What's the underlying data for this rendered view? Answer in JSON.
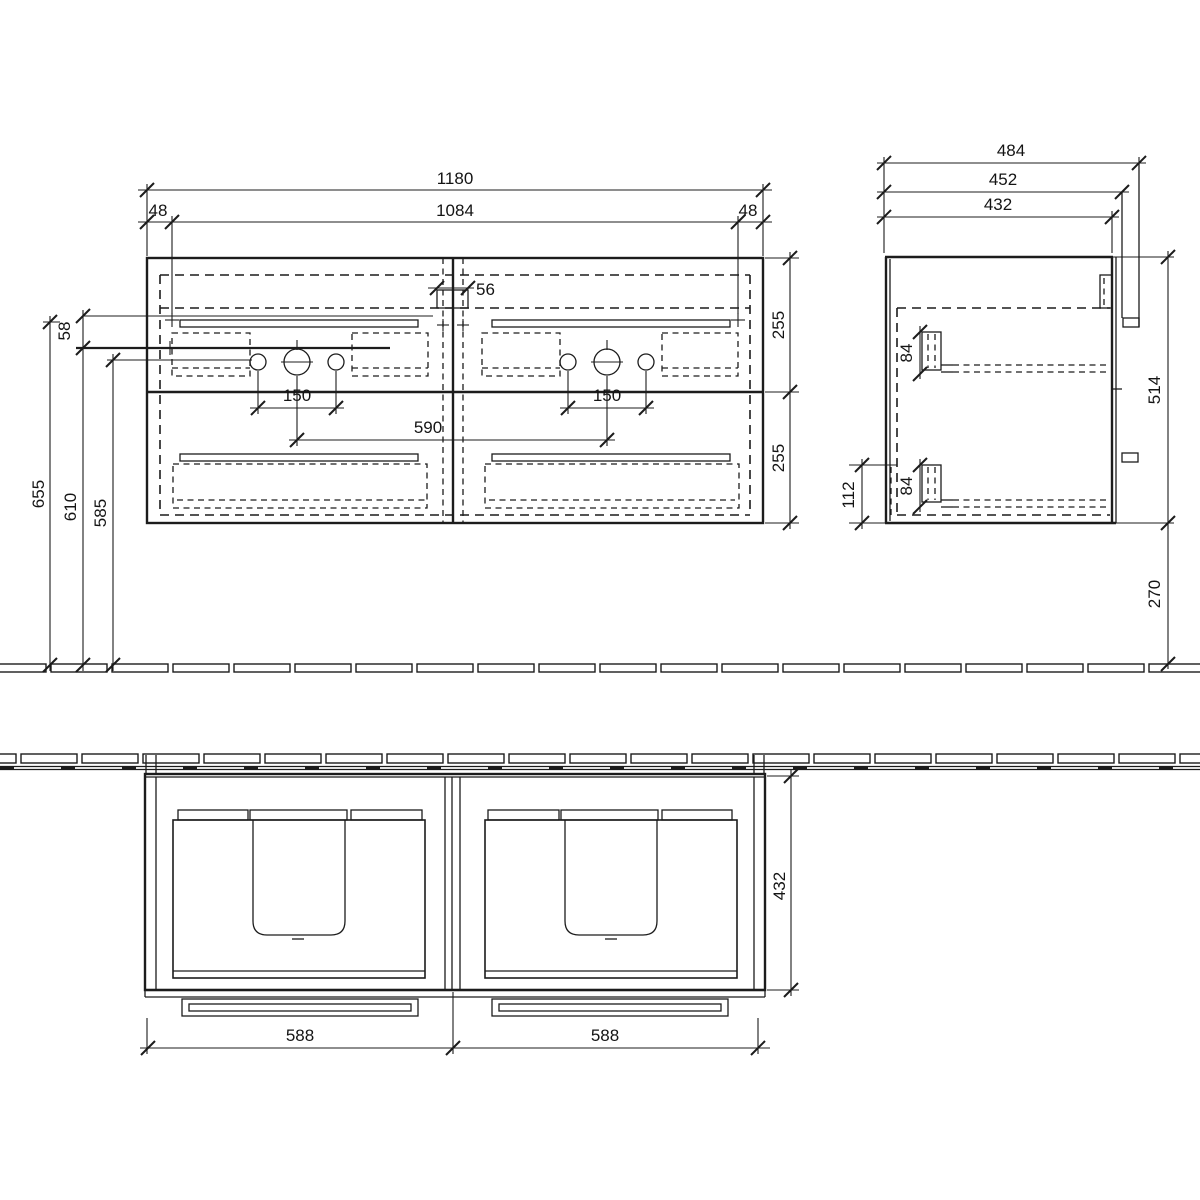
{
  "drawing": {
    "type": "technical-drawing",
    "subject": "wall-hung double-basin vanity unit",
    "units": "mm",
    "colors": {
      "line": "#1c1c1c",
      "background": "#ffffff"
    },
    "front_view": {
      "overall_width": "1180",
      "fixing_centres_width": "1084",
      "left_offset": "48",
      "right_offset": "48",
      "centre_gap": "56",
      "top_drawer_height": "255",
      "bottom_drawer_height": "255",
      "tap_hole_spacing_left": "150",
      "tap_hole_spacing_right": "150",
      "bowl_centres": "590",
      "fixing_drop": "58",
      "height_to_top": "655",
      "height_to_rail": "610",
      "height_to_tap_line": "585"
    },
    "side_view": {
      "overall_depth": "484",
      "depth_incl_back": "452",
      "carcass_depth": "432",
      "runner_height_top": "84",
      "runner_height_bottom": "84",
      "bottom_clearance": "112",
      "carcass_height": "514",
      "floor_clearance": "270"
    },
    "plan_view": {
      "carcass_depth": "432",
      "left_door_width": "588",
      "right_door_width": "588"
    }
  }
}
